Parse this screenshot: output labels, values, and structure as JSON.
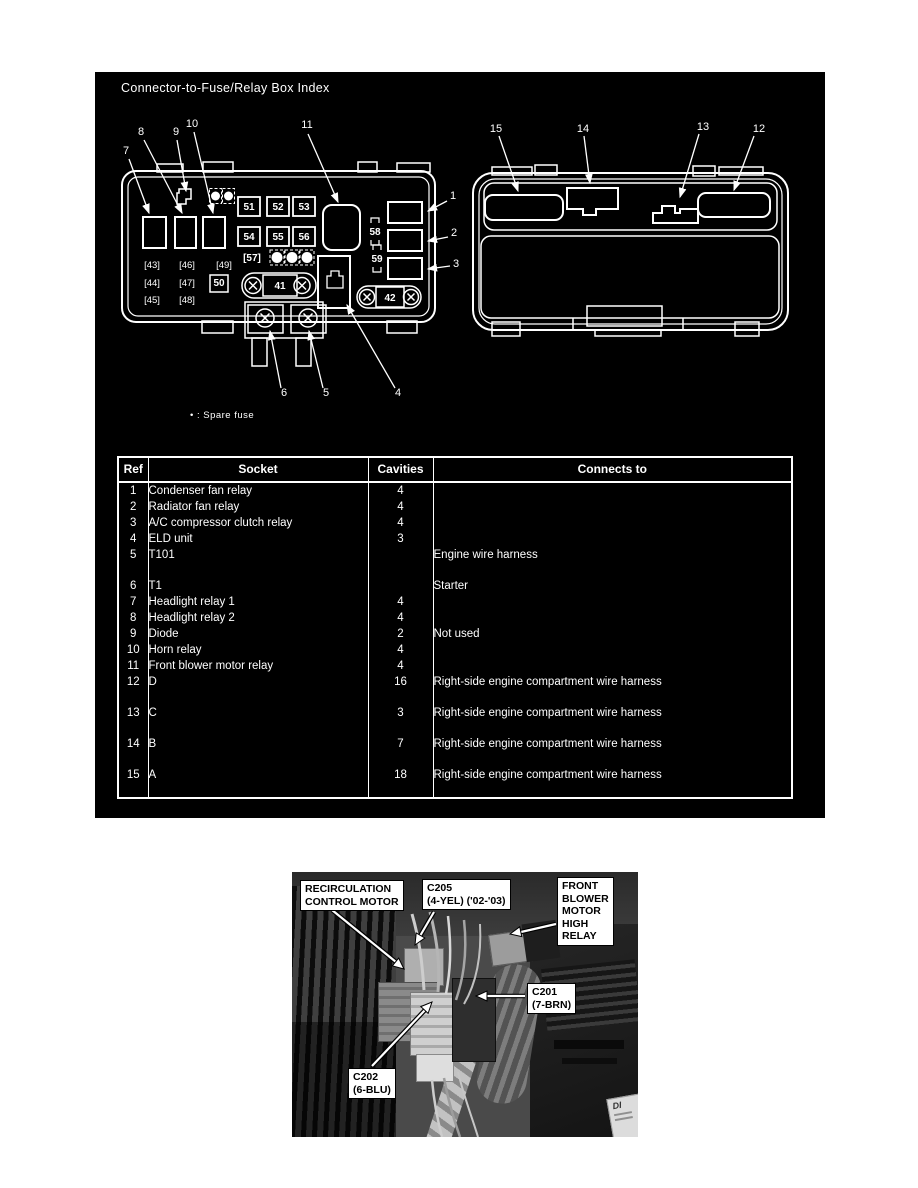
{
  "panel": {
    "title": "Connector-to-Fuse/Relay Box Index"
  },
  "diagram": {
    "note": "• : Spare fuse",
    "callouts": {
      "1": "1",
      "2": "2",
      "3": "3",
      "4": "4",
      "5": "5",
      "6": "6",
      "7": "7",
      "8": "8",
      "9": "9",
      "10": "10",
      "11": "11",
      "12": "12",
      "13": "13",
      "14": "14",
      "15": "15"
    },
    "fuses": {
      "51": "51",
      "52": "52",
      "53": "53",
      "54": "54",
      "55": "55",
      "56": "56"
    },
    "fuse50": "50",
    "fuse57": "[57]",
    "brackets": {
      "43": "[43]",
      "44": "[44]",
      "45": "[45]",
      "46": "[46]",
      "47": "[47]",
      "48": "[48]",
      "49": "[49]"
    },
    "bolts": {
      "41": "41",
      "42": "42"
    },
    "sockets": {
      "58": "58",
      "59": "59"
    }
  },
  "table": {
    "headers": [
      "Ref",
      "Socket",
      "Cavities",
      "Connects to"
    ],
    "rows": [
      {
        "ref": "1",
        "socket": "Condenser fan relay",
        "cavities": "4",
        "connects": ""
      },
      {
        "ref": "2",
        "socket": "Radiator fan relay",
        "cavities": "4",
        "connects": ""
      },
      {
        "ref": "3",
        "socket": "A/C compressor clutch relay",
        "cavities": "4",
        "connects": ""
      },
      {
        "ref": "4",
        "socket": "ELD unit",
        "cavities": "3",
        "connects": ""
      },
      {
        "ref": "5",
        "socket": "T101",
        "cavities": "",
        "connects": "Engine wire harness"
      },
      {
        "ref": "6",
        "socket": "T1",
        "cavities": "",
        "connects": "Starter"
      },
      {
        "ref": "7",
        "socket": "Headlight relay 1",
        "cavities": "4",
        "connects": ""
      },
      {
        "ref": "8",
        "socket": "Headlight relay 2",
        "cavities": "4",
        "connects": ""
      },
      {
        "ref": "9",
        "socket": "Diode",
        "cavities": "2",
        "connects": "Not used"
      },
      {
        "ref": "10",
        "socket": "Horn relay",
        "cavities": "4",
        "connects": ""
      },
      {
        "ref": "11",
        "socket": "Front blower motor relay",
        "cavities": "4",
        "connects": ""
      },
      {
        "ref": "12",
        "socket": "D",
        "cavities": "16",
        "connects": "Right-side engine compartment wire harness"
      },
      {
        "ref": "13",
        "socket": "C",
        "cavities": "3",
        "connects": "Right-side engine compartment wire harness"
      },
      {
        "ref": "14",
        "socket": "B",
        "cavities": "7",
        "connects": "Right-side engine compartment wire harness"
      },
      {
        "ref": "15",
        "socket": "A",
        "cavities": "18",
        "connects": "Right-side engine compartment wire harness"
      }
    ]
  },
  "photo": {
    "labels": {
      "recirc": [
        "RECIRCULATION",
        "CONTROL MOTOR"
      ],
      "c205": [
        "C205",
        "(4-YEL) ('02-'03)"
      ],
      "blower": [
        "FRONT",
        "BLOWER",
        "MOTOR",
        "HIGH",
        "RELAY"
      ],
      "c201": [
        "C201",
        "(7-BRN)"
      ],
      "c202": [
        "C202",
        "(6-BLU)"
      ],
      "corner": "DI"
    }
  }
}
